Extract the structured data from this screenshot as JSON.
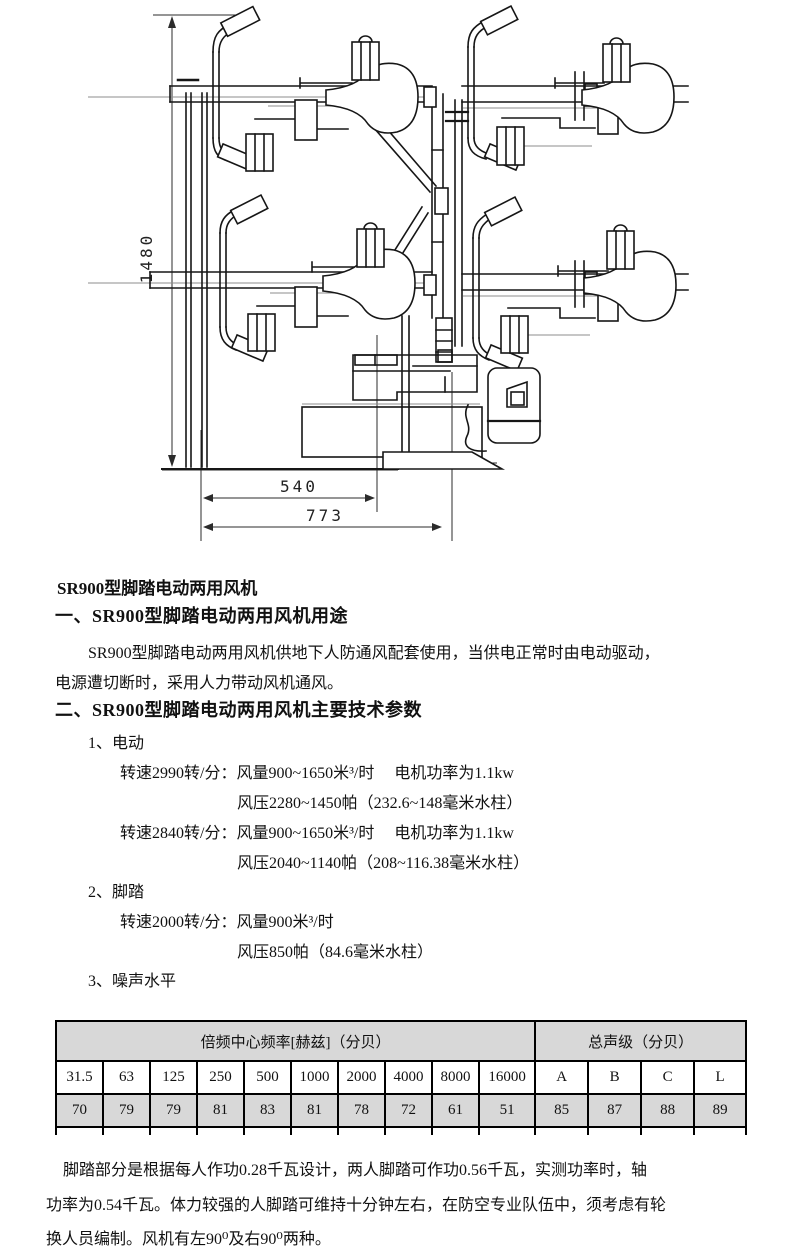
{
  "diagram": {
    "dim_height": "1480",
    "dim_width_inner": "540",
    "dim_width_outer": "773"
  },
  "doc": {
    "title": "SR900型脚踏电动两用风机",
    "section1_heading": "一、SR900型脚踏电动两用风机用途",
    "intro_line1": "SR900型脚踏电动两用风机供地下人防通风配套使用，当供电正常时由电动驱动，",
    "intro_line2": "电源遭切断时，采用人力带动风机通风。",
    "section2_heading": "二、SR900型脚踏电动两用风机主要技术参数",
    "item1_label": "1、电动",
    "elec_line1": "转速2990转/分：风量900~1650米³/时　 电机功率为1.1kw",
    "elec_line2": "风压2280~1450帕（232.6~148毫米水柱）",
    "elec_line3": "转速2840转/分：风量900~1650米³/时　 电机功率为1.1kw",
    "elec_line4": "风压2040~1140帕（208~116.38毫米水柱）",
    "item2_label": "2、脚踏",
    "pedal_line1": "转速2000转/分：风量900米³/时",
    "pedal_line2": "风压850帕（84.6毫米水柱）",
    "item3_label": "3、噪声水平"
  },
  "noise_table": {
    "freq_header": "倍频中心频率[赫兹]（分贝）",
    "total_header": "总声级（分贝）",
    "freq_labels": [
      "31.5",
      "63",
      "125",
      "250",
      "500",
      "1000",
      "2000",
      "4000",
      "8000",
      "16000"
    ],
    "total_labels": [
      "A",
      "B",
      "C",
      "L"
    ],
    "freq_values": [
      "70",
      "79",
      "79",
      "81",
      "83",
      "81",
      "78",
      "72",
      "61",
      "51"
    ],
    "total_values": [
      "85",
      "87",
      "88",
      "89"
    ],
    "header_bg": "#d8d8d8"
  },
  "footer": {
    "line1": "脚踏部分是根据每人作功0.28千瓦设计，两人脚踏可作功0.56千瓦，实测功率时，轴",
    "line2": "功率为0.54千瓦。体力较强的人脚踏可维持十分钟左右，在防空专业队伍中，须考虑有轮",
    "line3": "换人员编制。风机有左90⁰及右90⁰两种。"
  }
}
